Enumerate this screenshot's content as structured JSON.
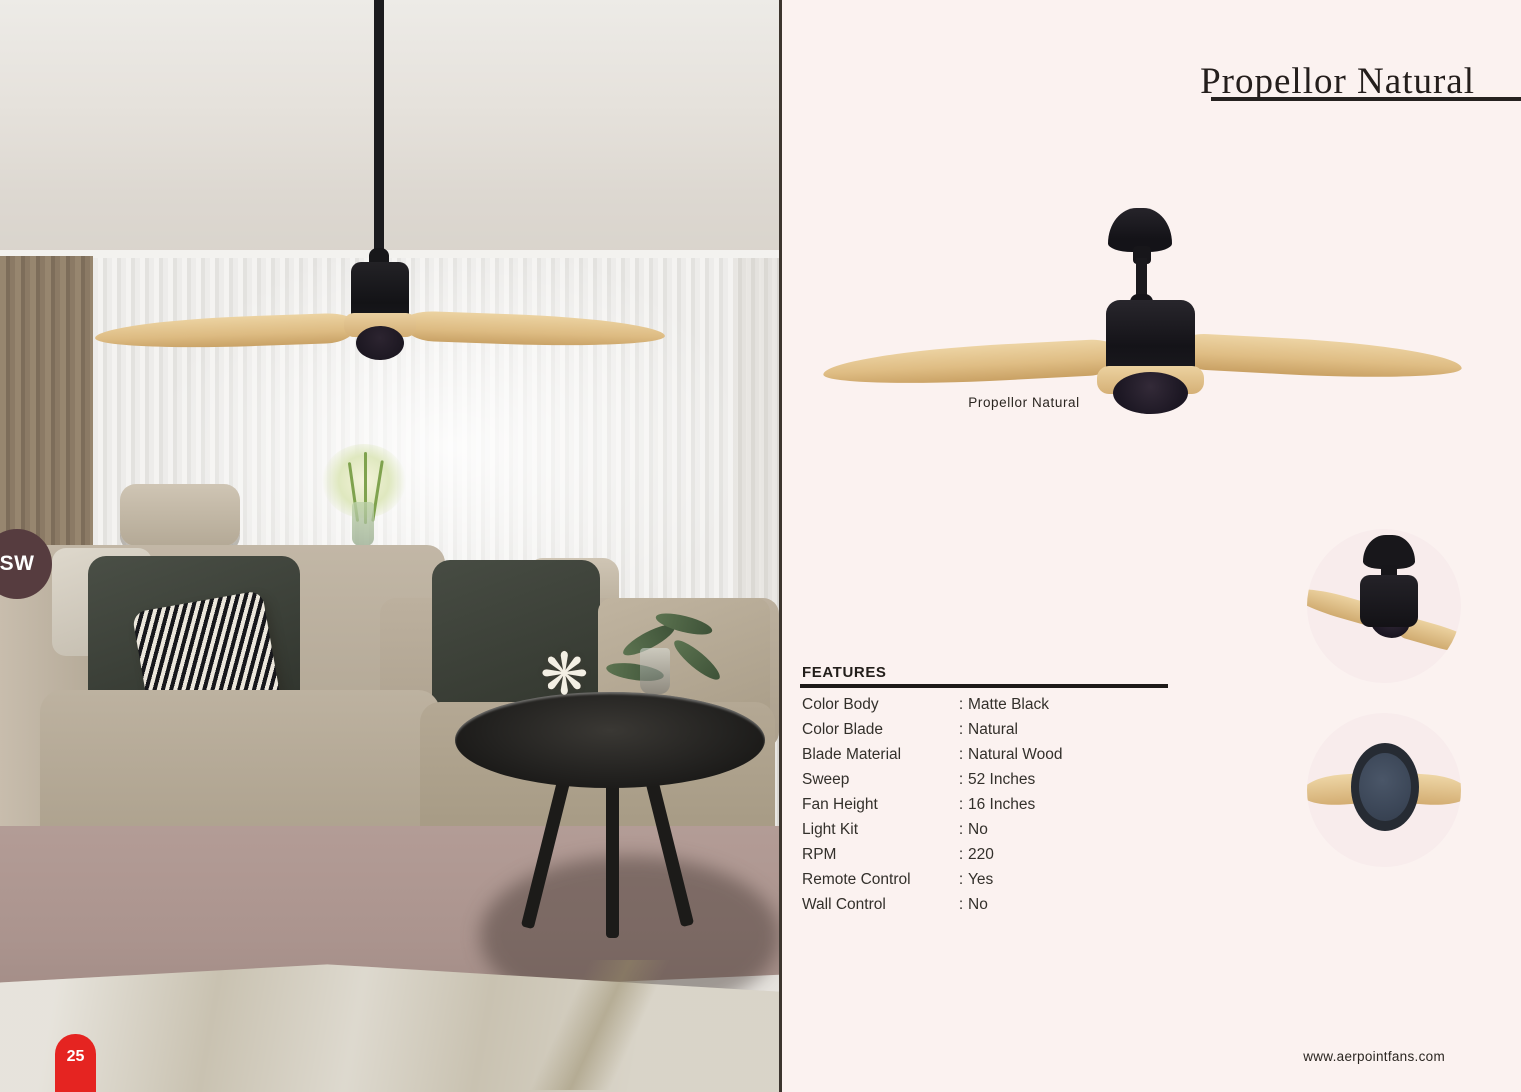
{
  "page": {
    "title": "Propellor Natural",
    "page_number": "25",
    "side_tab": "SW",
    "website": "www.aerpointfans.com"
  },
  "product": {
    "name": "Propellor Natural",
    "caption": "Propellor Natural",
    "color_body_hex": "#1a191d",
    "color_blade_hex": "#dfbd84"
  },
  "features": {
    "heading": "FEATURES",
    "separator": ":",
    "rows": [
      {
        "label": "Color Body",
        "value": "Matte Black"
      },
      {
        "label": "Color Blade",
        "value": "Natural"
      },
      {
        "label": "Blade Material",
        "value": "Natural Wood"
      },
      {
        "label": "Sweep",
        "value": "52 Inches"
      },
      {
        "label": "Fan Height",
        "value": "16 Inches"
      },
      {
        "label": "Light Kit",
        "value": "No"
      },
      {
        "label": "RPM",
        "value": "220"
      },
      {
        "label": "Remote Control",
        "value": "Yes"
      },
      {
        "label": "Wall Control",
        "value": "No"
      }
    ]
  },
  "certifications": [
    {
      "icon": "color-wheel-icon",
      "line1": "Color",
      "line2": "Customisation",
      "line1_color": "#e8198b",
      "line2_color": "#3fbde4"
    },
    {
      "icon": "summer-winter-icon",
      "line1": "Summer",
      "line2": "Winter",
      "line1_color": "#69ccd6",
      "line2_color": "#f0c01d"
    }
  ],
  "colors": {
    "panel_background": "#fbf2f0",
    "accent_red": "#e52421",
    "side_tab_maroon": "#563c3f",
    "text_dark": "#241e1c",
    "motor_underside_navy": "#3c4758"
  }
}
